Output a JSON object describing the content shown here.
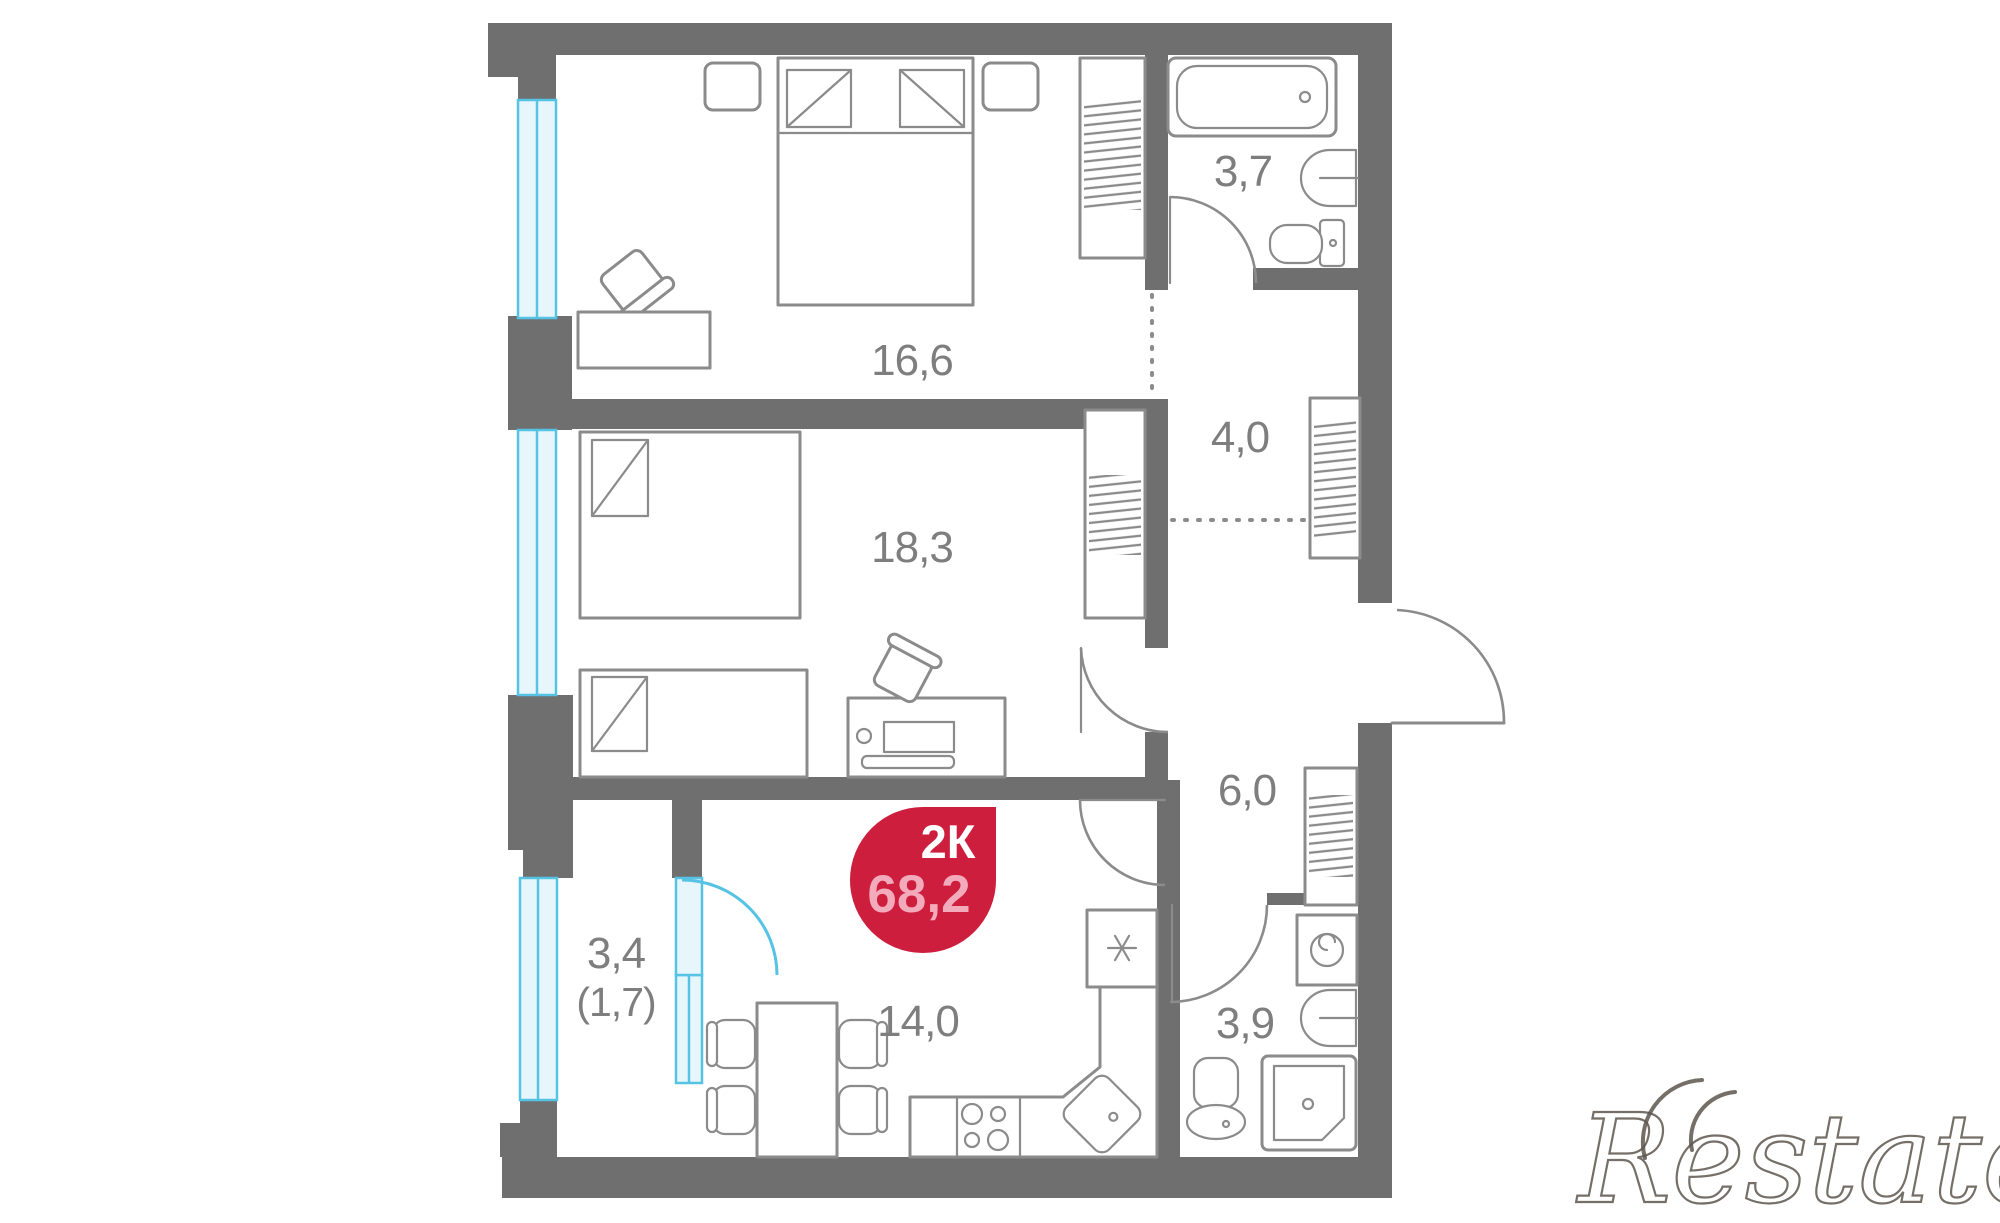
{
  "colors": {
    "wall": "#6f6f6f",
    "line": "#8b8b8b",
    "window": "#56c3e4",
    "windowFill": "#e6f6fb",
    "badge": "#ce1e3d",
    "badgeArea": "#f3aabb",
    "label": "#7e7e7e",
    "watermark": "#5d564e"
  },
  "badge": {
    "type": "2К",
    "area": "68,2"
  },
  "watermark": {
    "text": "Restate"
  },
  "rooms": [
    {
      "name": "bedroom",
      "area": "16,6"
    },
    {
      "name": "bedroom-2",
      "area": "18,3"
    },
    {
      "name": "wardrobe-hall",
      "area": "4,0"
    },
    {
      "name": "bathroom",
      "area": "3,7"
    },
    {
      "name": "hallway",
      "area": "6,0"
    },
    {
      "name": "kitchen",
      "area": "14,0"
    },
    {
      "name": "bathroom-2",
      "area": "3,9"
    },
    {
      "name": "balcony",
      "area": "3,4",
      "area_coef": "(1,7)"
    }
  ]
}
